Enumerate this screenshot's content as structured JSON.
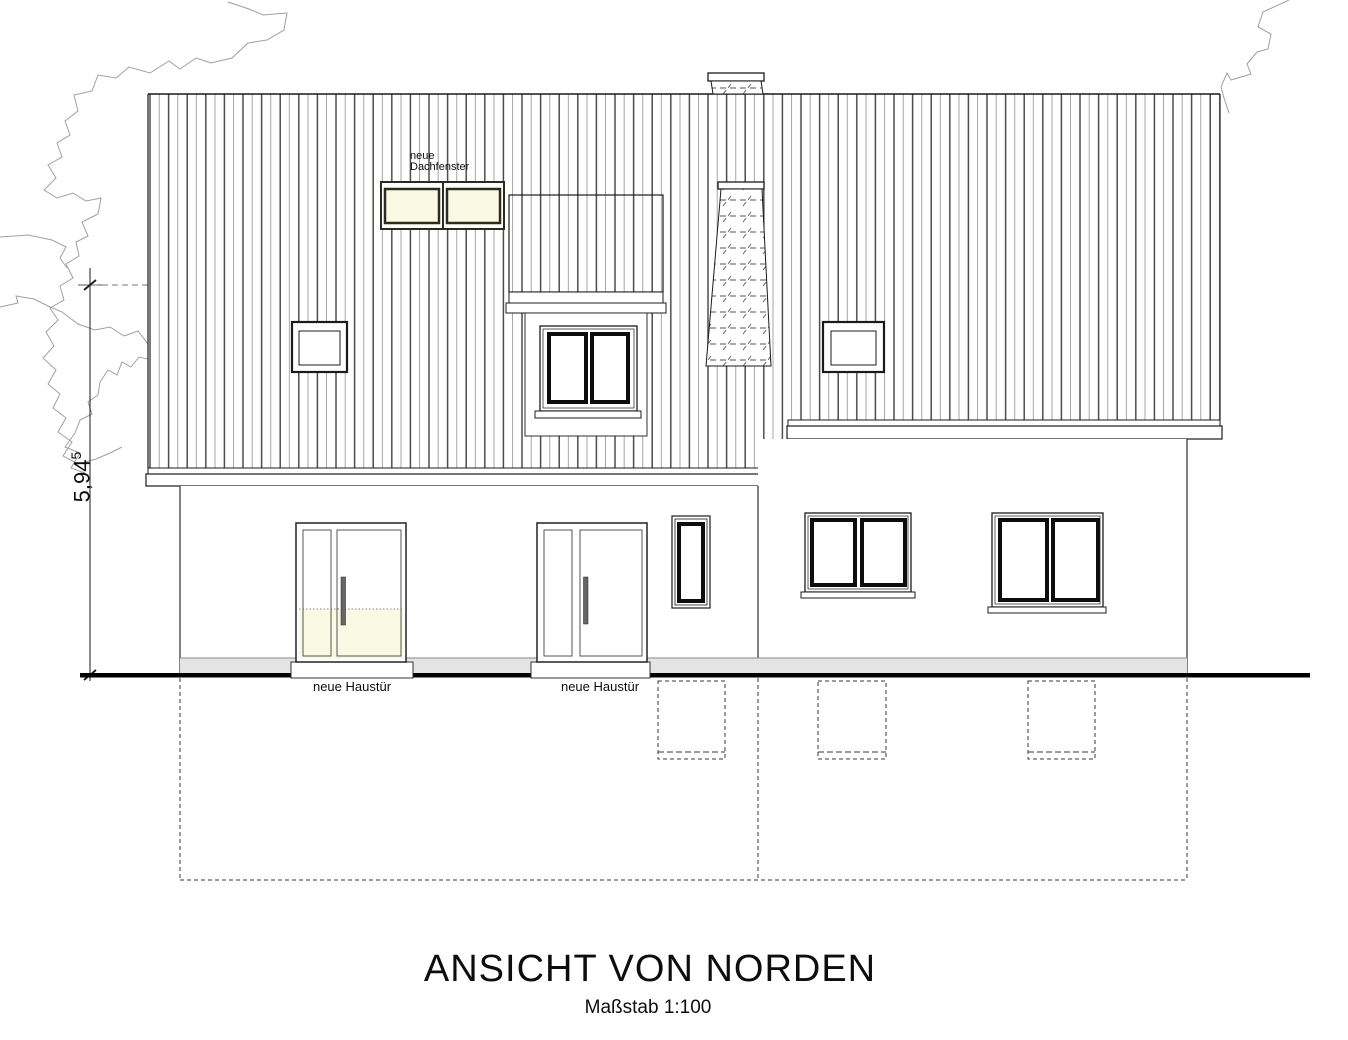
{
  "drawing": {
    "title": "ANSICHT VON NORDEN",
    "scale_label": "Maßstab 1:100"
  },
  "labels": {
    "roof_windows": "neue\nDachfenster",
    "door_left": "neue Haustür",
    "door_center": "neue Haustür"
  },
  "dimension": {
    "value": "5,94",
    "superscript": "5"
  },
  "colors": {
    "glass_cream": "#FAF9E4",
    "plinth_gray": "#E4E4E4",
    "line_black": "#1b1b1b",
    "tree_gray": "#a0a0a0"
  }
}
